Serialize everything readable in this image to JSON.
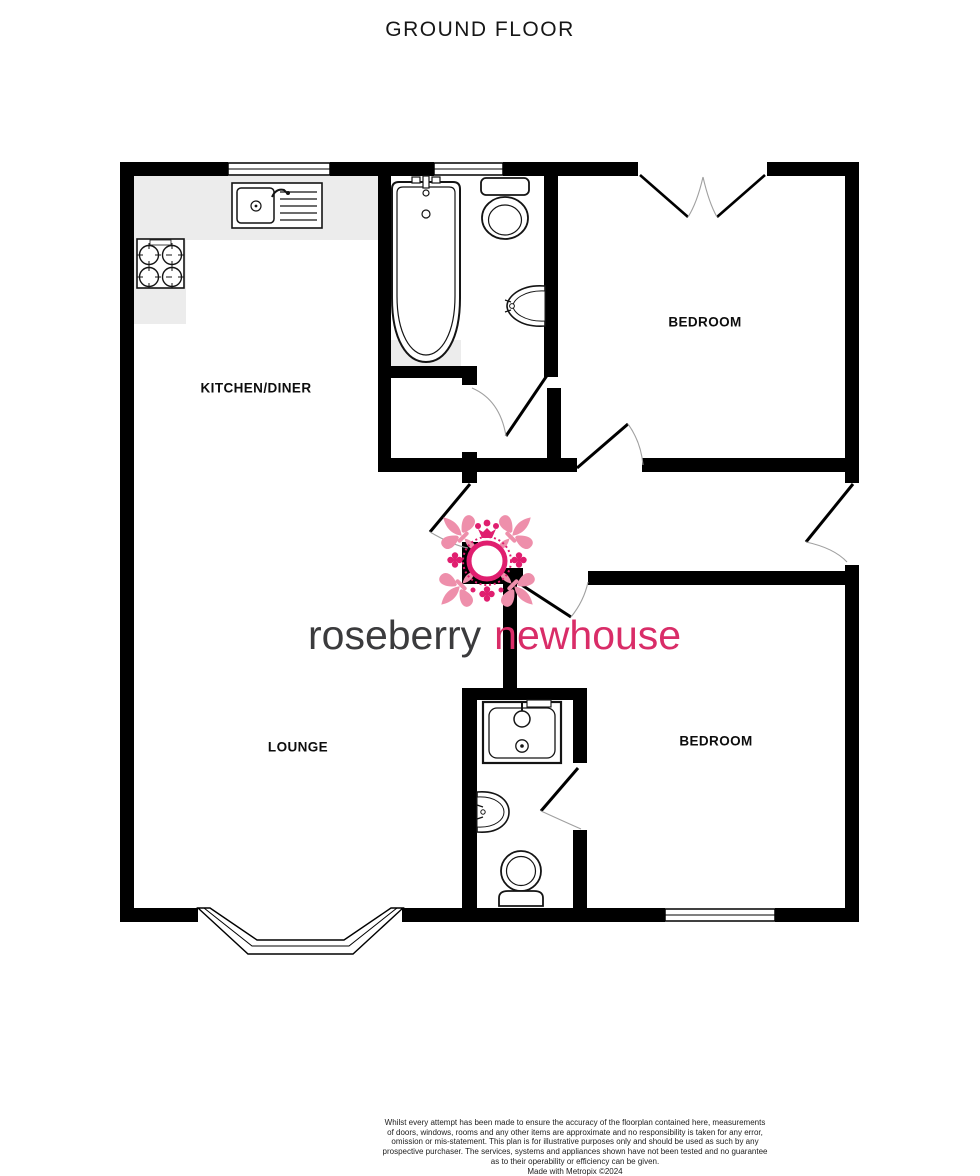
{
  "page": {
    "title": "GROUND FLOOR",
    "background": "#ffffff"
  },
  "floorplan": {
    "rooms": [
      {
        "id": "kitchen-diner",
        "label": "KITCHEN/DINER"
      },
      {
        "id": "bedroom-top",
        "label": "BEDROOM"
      },
      {
        "id": "lounge",
        "label": "LOUNGE"
      },
      {
        "id": "bedroom-bottom",
        "label": "BEDROOM"
      }
    ],
    "fixtures": [
      "kitchen-sink-icon",
      "hob-icon",
      "bath-icon",
      "toilet-icon",
      "wash-basin-icon",
      "shower-tray-icon",
      "wash-basin-icon",
      "toilet-icon"
    ],
    "features": [
      "window",
      "bay-window",
      "french-doors",
      "entrance-door",
      "internal-doors"
    ],
    "wall_color": "#000000",
    "counter_color": "#ececec"
  },
  "logo": {
    "brand_left": "roseberry",
    "brand_right": "newhouse",
    "emblem": "fleur-de-lis-crest-icon",
    "colors": {
      "left_text": "#3b3b3d",
      "right_text": "#d92d68",
      "pink_light": "#ee8fab",
      "pink_dark": "#e01e6f"
    }
  },
  "disclaimer": {
    "lines": [
      "Whilst every attempt has been made to ensure the accuracy of the floorplan contained here, measurements",
      "of doors, windows, rooms and any other items are approximate and no responsibility is taken for any error,",
      "omission or mis-statement. This plan is for illustrative purposes only and should be used as such by any",
      "prospective purchaser. The services, systems and appliances shown have not been tested and no guarantee",
      "as to their operability or efficiency can be given.",
      "Made with Metropix ©2024"
    ]
  }
}
